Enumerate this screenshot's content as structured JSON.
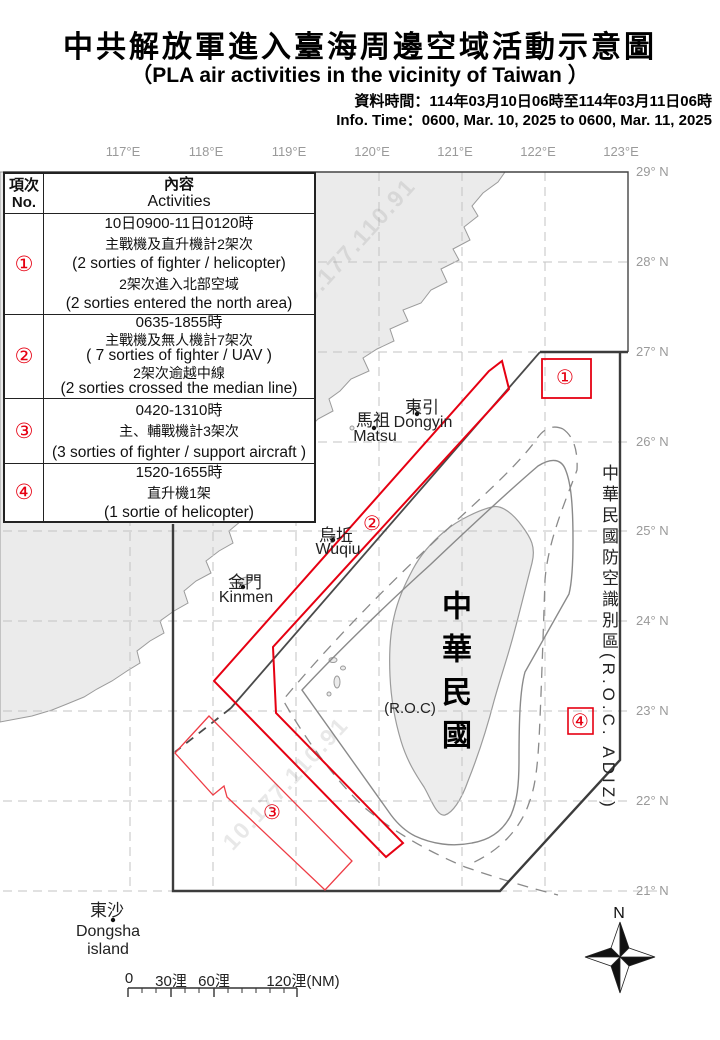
{
  "header": {
    "title_zh": "中共解放軍進入臺海周邊空域活動示意圖",
    "title_en": "（PLA air activities in the vicinity of Taiwan ）",
    "data_time_zh": "資料時間：114年03月10日06時至114年03月11日06時",
    "info_time_en": "Info. Time：0600, Mar. 10, 2025 to 0600, Mar. 11, 2025"
  },
  "table": {
    "header": {
      "no_zh": "項次",
      "no_en": "No.",
      "content_zh": "內容",
      "content_en": "Activities"
    },
    "rows": [
      {
        "no": "①",
        "lines": [
          "10日0900-11日0120時",
          "主戰機及直升機計2架次",
          "(2 sorties of fighter / helicopter)",
          "2架次進入北部空域",
          "(2 sorties entered the north area)"
        ]
      },
      {
        "no": "②",
        "lines": [
          "0635-1855時",
          "主戰機及無人機計7架次",
          "( 7 sorties of fighter / UAV )",
          "2架次逾越中線",
          "(2 sorties crossed the median line)"
        ]
      },
      {
        "no": "③",
        "lines": [
          "0420-1310時",
          "主、輔戰機計3架次",
          "(3 sorties of fighter / support aircraft )"
        ]
      },
      {
        "no": "④",
        "lines": [
          "1520-1655時",
          "直升機1架",
          "(1 sortie of helicopter)"
        ]
      }
    ]
  },
  "map": {
    "lon_labels": [
      "117°E",
      "118°E",
      "119°E",
      "120°E",
      "121°E",
      "122°E",
      "123°E"
    ],
    "lat_labels": [
      "29° N",
      "28° N",
      "27° N",
      "26° N",
      "25° N",
      "24° N",
      "23° N",
      "22° N",
      "21° N"
    ],
    "places": {
      "dongyin_zh": "東引",
      "dongyin_en": "Dongyin",
      "matsu_zh": "馬祖",
      "matsu_en": "Matsu",
      "wuqiu_zh": "烏坵",
      "wuqiu_en": "Wuqiu",
      "kinmen_zh": "金門",
      "kinmen_en": "Kinmen",
      "dongsha_zh": "東沙",
      "dongsha_en1": "Dongsha",
      "dongsha_en2": "island"
    },
    "taiwan_label": "中華民國",
    "roc_label": "(R.O.C)",
    "adiz_label": "中華民國防空識別區(R.O.C. ADIZ)",
    "area_markers": [
      "①",
      "②",
      "③",
      "④"
    ],
    "scale": {
      "t0": "0",
      "t30": "30浬",
      "t60": "60浬",
      "t120": "120浬(NM)"
    },
    "compass_n": "N",
    "watermark": "10.177.110.91",
    "colors": {
      "activity_red": "#e60012",
      "adiz_dark": "#3c3c3c",
      "grid": "#c3c3c3",
      "land": "#ebebeb",
      "coast": "#9b9b9b",
      "label_gray": "#9a9a9a"
    }
  }
}
